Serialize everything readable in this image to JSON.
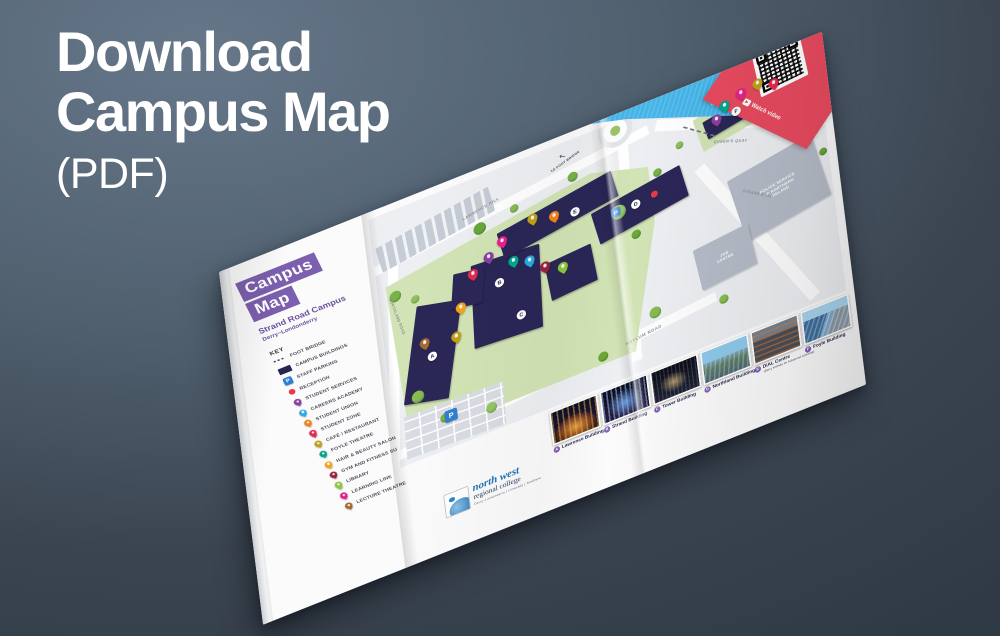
{
  "headline": {
    "line1": "Download",
    "line2": "Campus Map",
    "line3": "(PDF)"
  },
  "colors": {
    "accent_purple": "#7c5fae",
    "qr_red": "#e84a5f",
    "river_blue": "#45b5e8",
    "building_navy": "#2a2757",
    "campus_green": "#d2e4b5",
    "photo_badge_purple": "#7d5fb2"
  },
  "cover": {
    "title_top": "Campus",
    "title_bottom": "Map",
    "campus": "Strand Road Campus",
    "city": "Derry~Londonderry",
    "key_title": "KEY"
  },
  "key_items": [
    {
      "label": "FOOT BRIDGE",
      "kind": "dash",
      "color": "#44444f"
    },
    {
      "label": "CAMPUS BUILDINGS",
      "kind": "rect",
      "color": "#27244f"
    },
    {
      "label": "STAFF PARKING",
      "kind": "p",
      "color": "#2e7fd2"
    },
    {
      "label": "RECEPTION",
      "kind": "dot",
      "color": "#e63a46"
    },
    {
      "label": "STUDENT SERVICES",
      "kind": "pin",
      "color": "#8a3fa0"
    },
    {
      "label": "CAREERS ACADEMY",
      "kind": "pin",
      "color": "#29abe2"
    },
    {
      "label": "STUDENT UNION",
      "kind": "pin",
      "color": "#f0821e"
    },
    {
      "label": "STUDENT ZONE",
      "kind": "pin",
      "color": "#e52a4e"
    },
    {
      "label": "CAFÉ / RESTAURANT",
      "kind": "pin",
      "color": "#c2a018"
    },
    {
      "label": "FOYLE THEATRE",
      "kind": "pin",
      "color": "#00a78e"
    },
    {
      "label": "HAIR & BEAUTY SALON",
      "kind": "pin",
      "color": "#f6a21d"
    },
    {
      "label": "GYM AND FITNESS SUITE",
      "kind": "pin",
      "color": "#9a2240"
    },
    {
      "label": "LIBRARY",
      "kind": "pin",
      "color": "#8dc63f"
    },
    {
      "label": "LEARNING LINK",
      "kind": "pin",
      "color": "#e81f8d"
    },
    {
      "label": "LECTURE THEATRE",
      "kind": "pin",
      "color": "#a36a2f"
    }
  ],
  "map": {
    "river_label": "RIVER FOYLE",
    "annotation": "TO FOOT BRIDGE",
    "police_l1": "POLICE SERVICE",
    "police_l2": "OF NORTHERN",
    "police_l3": "IRELAND",
    "job_l1": "JOB",
    "job_l2": "CENTRE",
    "road_labels": [
      {
        "text": "LAWRENCE HILL",
        "x": 116,
        "y": 42,
        "rot": -11,
        "size": 5
      },
      {
        "text": "NORTHLAND ROAD",
        "x": -8,
        "y": 140,
        "rot": 78,
        "size": 5
      },
      {
        "text": "ASYLUM ROAD",
        "x": 298,
        "y": 295,
        "rot": -7,
        "size": 5.5
      },
      {
        "text": "STRAND ROAD",
        "x": 462,
        "y": 168,
        "rot": 33,
        "size": 5
      },
      {
        "text": "QUEEN'S QUAY",
        "x": 436,
        "y": 84,
        "rot": 21,
        "size": 5
      }
    ],
    "markers": [
      {
        "kind": "pin",
        "color": "#8a3fa0",
        "x": 136,
        "y": 106
      },
      {
        "kind": "pin",
        "color": "#e81f8d",
        "x": 155,
        "y": 92
      },
      {
        "kind": "pin",
        "color": "#c2a018",
        "x": 196,
        "y": 78
      },
      {
        "kind": "pin",
        "color": "#f0821e",
        "x": 223,
        "y": 86
      },
      {
        "kind": "pin",
        "color": "#00a78e",
        "x": 166,
        "y": 124
      },
      {
        "kind": "pin",
        "color": "#29abe2",
        "x": 186,
        "y": 132
      },
      {
        "kind": "pin",
        "color": "#e52a4e",
        "x": 114,
        "y": 120
      },
      {
        "kind": "pin",
        "color": "#9a2240",
        "x": 204,
        "y": 148
      },
      {
        "kind": "pin",
        "color": "#8dc63f",
        "x": 226,
        "y": 158
      },
      {
        "kind": "pin",
        "color": "#a36a2f",
        "x": 44,
        "y": 186
      },
      {
        "kind": "pin",
        "color": "#c2a018",
        "x": 84,
        "y": 194
      },
      {
        "kind": "pin",
        "color": "#f6a21d",
        "x": 94,
        "y": 158
      },
      {
        "kind": "pin",
        "color": "#00a78e",
        "x": 450,
        "y": 30
      },
      {
        "kind": "pin",
        "color": "#e81f8d",
        "x": 472,
        "y": 22
      },
      {
        "kind": "pin",
        "color": "#c2a018",
        "x": 494,
        "y": 18
      },
      {
        "kind": "pin",
        "color": "#e52a4e",
        "x": 514,
        "y": 26
      },
      {
        "kind": "pin",
        "color": "#8a3fa0",
        "x": 438,
        "y": 44
      },
      {
        "kind": "dot",
        "color": "#e63946",
        "x": 352,
        "y": 112
      },
      {
        "kind": "p",
        "x": 300,
        "y": 114,
        "size": 12
      },
      {
        "kind": "p",
        "x": 64,
        "y": 294,
        "size": 16
      },
      {
        "kind": "badge",
        "letter": "A",
        "x": 52,
        "y": 208
      },
      {
        "kind": "badge",
        "letter": "B",
        "x": 146,
        "y": 146
      },
      {
        "kind": "badge",
        "letter": "C",
        "x": 168,
        "y": 200
      },
      {
        "kind": "badge",
        "letter": "D",
        "x": 326,
        "y": 114
      },
      {
        "kind": "badge",
        "letter": "E",
        "x": 250,
        "y": 92
      },
      {
        "kind": "badge",
        "letter": "F",
        "x": 464,
        "y": 44
      }
    ],
    "trees": [
      {
        "x": 14,
        "y": 108,
        "s": 15,
        "c": "#79b248"
      },
      {
        "x": 40,
        "y": 124,
        "s": 11,
        "c": "#8fc25e"
      },
      {
        "x": 128,
        "y": 62,
        "s": 16,
        "c": "#6aa83a"
      },
      {
        "x": 176,
        "y": 56,
        "s": 11,
        "c": "#86bd52"
      },
      {
        "x": 252,
        "y": 44,
        "s": 13,
        "c": "#79b248"
      },
      {
        "x": 300,
        "y": 112,
        "s": 19,
        "c": "#93c765"
      },
      {
        "x": 322,
        "y": 154,
        "s": 12,
        "c": "#6aa83a"
      },
      {
        "x": 26,
        "y": 252,
        "s": 16,
        "c": "#86bd52"
      },
      {
        "x": 58,
        "y": 296,
        "s": 12,
        "c": "#79b248"
      },
      {
        "x": 116,
        "y": 306,
        "s": 14,
        "c": "#93c765"
      },
      {
        "x": 262,
        "y": 298,
        "s": 13,
        "c": "#6aa83a"
      },
      {
        "x": 332,
        "y": 266,
        "s": 15,
        "c": "#86bd52"
      },
      {
        "x": 358,
        "y": 84,
        "s": 11,
        "c": "#79b248"
      },
      {
        "x": 390,
        "y": 60,
        "s": 10,
        "c": "#8fc25e"
      },
      {
        "x": 528,
        "y": 104,
        "s": 12,
        "c": "#79b248"
      },
      {
        "x": 548,
        "y": 124,
        "s": 10,
        "c": "#8fc25e"
      },
      {
        "x": 566,
        "y": 144,
        "s": 10,
        "c": "#6aa83a"
      },
      {
        "x": 420,
        "y": 286,
        "s": 12,
        "c": "#86bd52"
      }
    ]
  },
  "qr": {
    "ribbon": "Watch video",
    "play_glyph": "▶"
  },
  "photos": [
    {
      "letter": "A",
      "name": "Lawrence Building",
      "style": "a"
    },
    {
      "letter": "B",
      "name": "Strand Building",
      "style": "b"
    },
    {
      "letter": "C",
      "name": "Tower Building",
      "style": "c"
    },
    {
      "letter": "D",
      "name": "Northland Building",
      "style": "d"
    },
    {
      "letter": "E",
      "name": "DiAL Centre",
      "sub": "(Derry Institute for Advanced Learning)",
      "style": "e"
    },
    {
      "letter": "F",
      "name": "Foyle Building",
      "style": "f"
    }
  ],
  "logo": {
    "name_top": "north west",
    "name_bottom": "regional college",
    "tagline": "Derry~Londonderry | Limavady | Strabane"
  },
  "annotation_arrow": "↖"
}
